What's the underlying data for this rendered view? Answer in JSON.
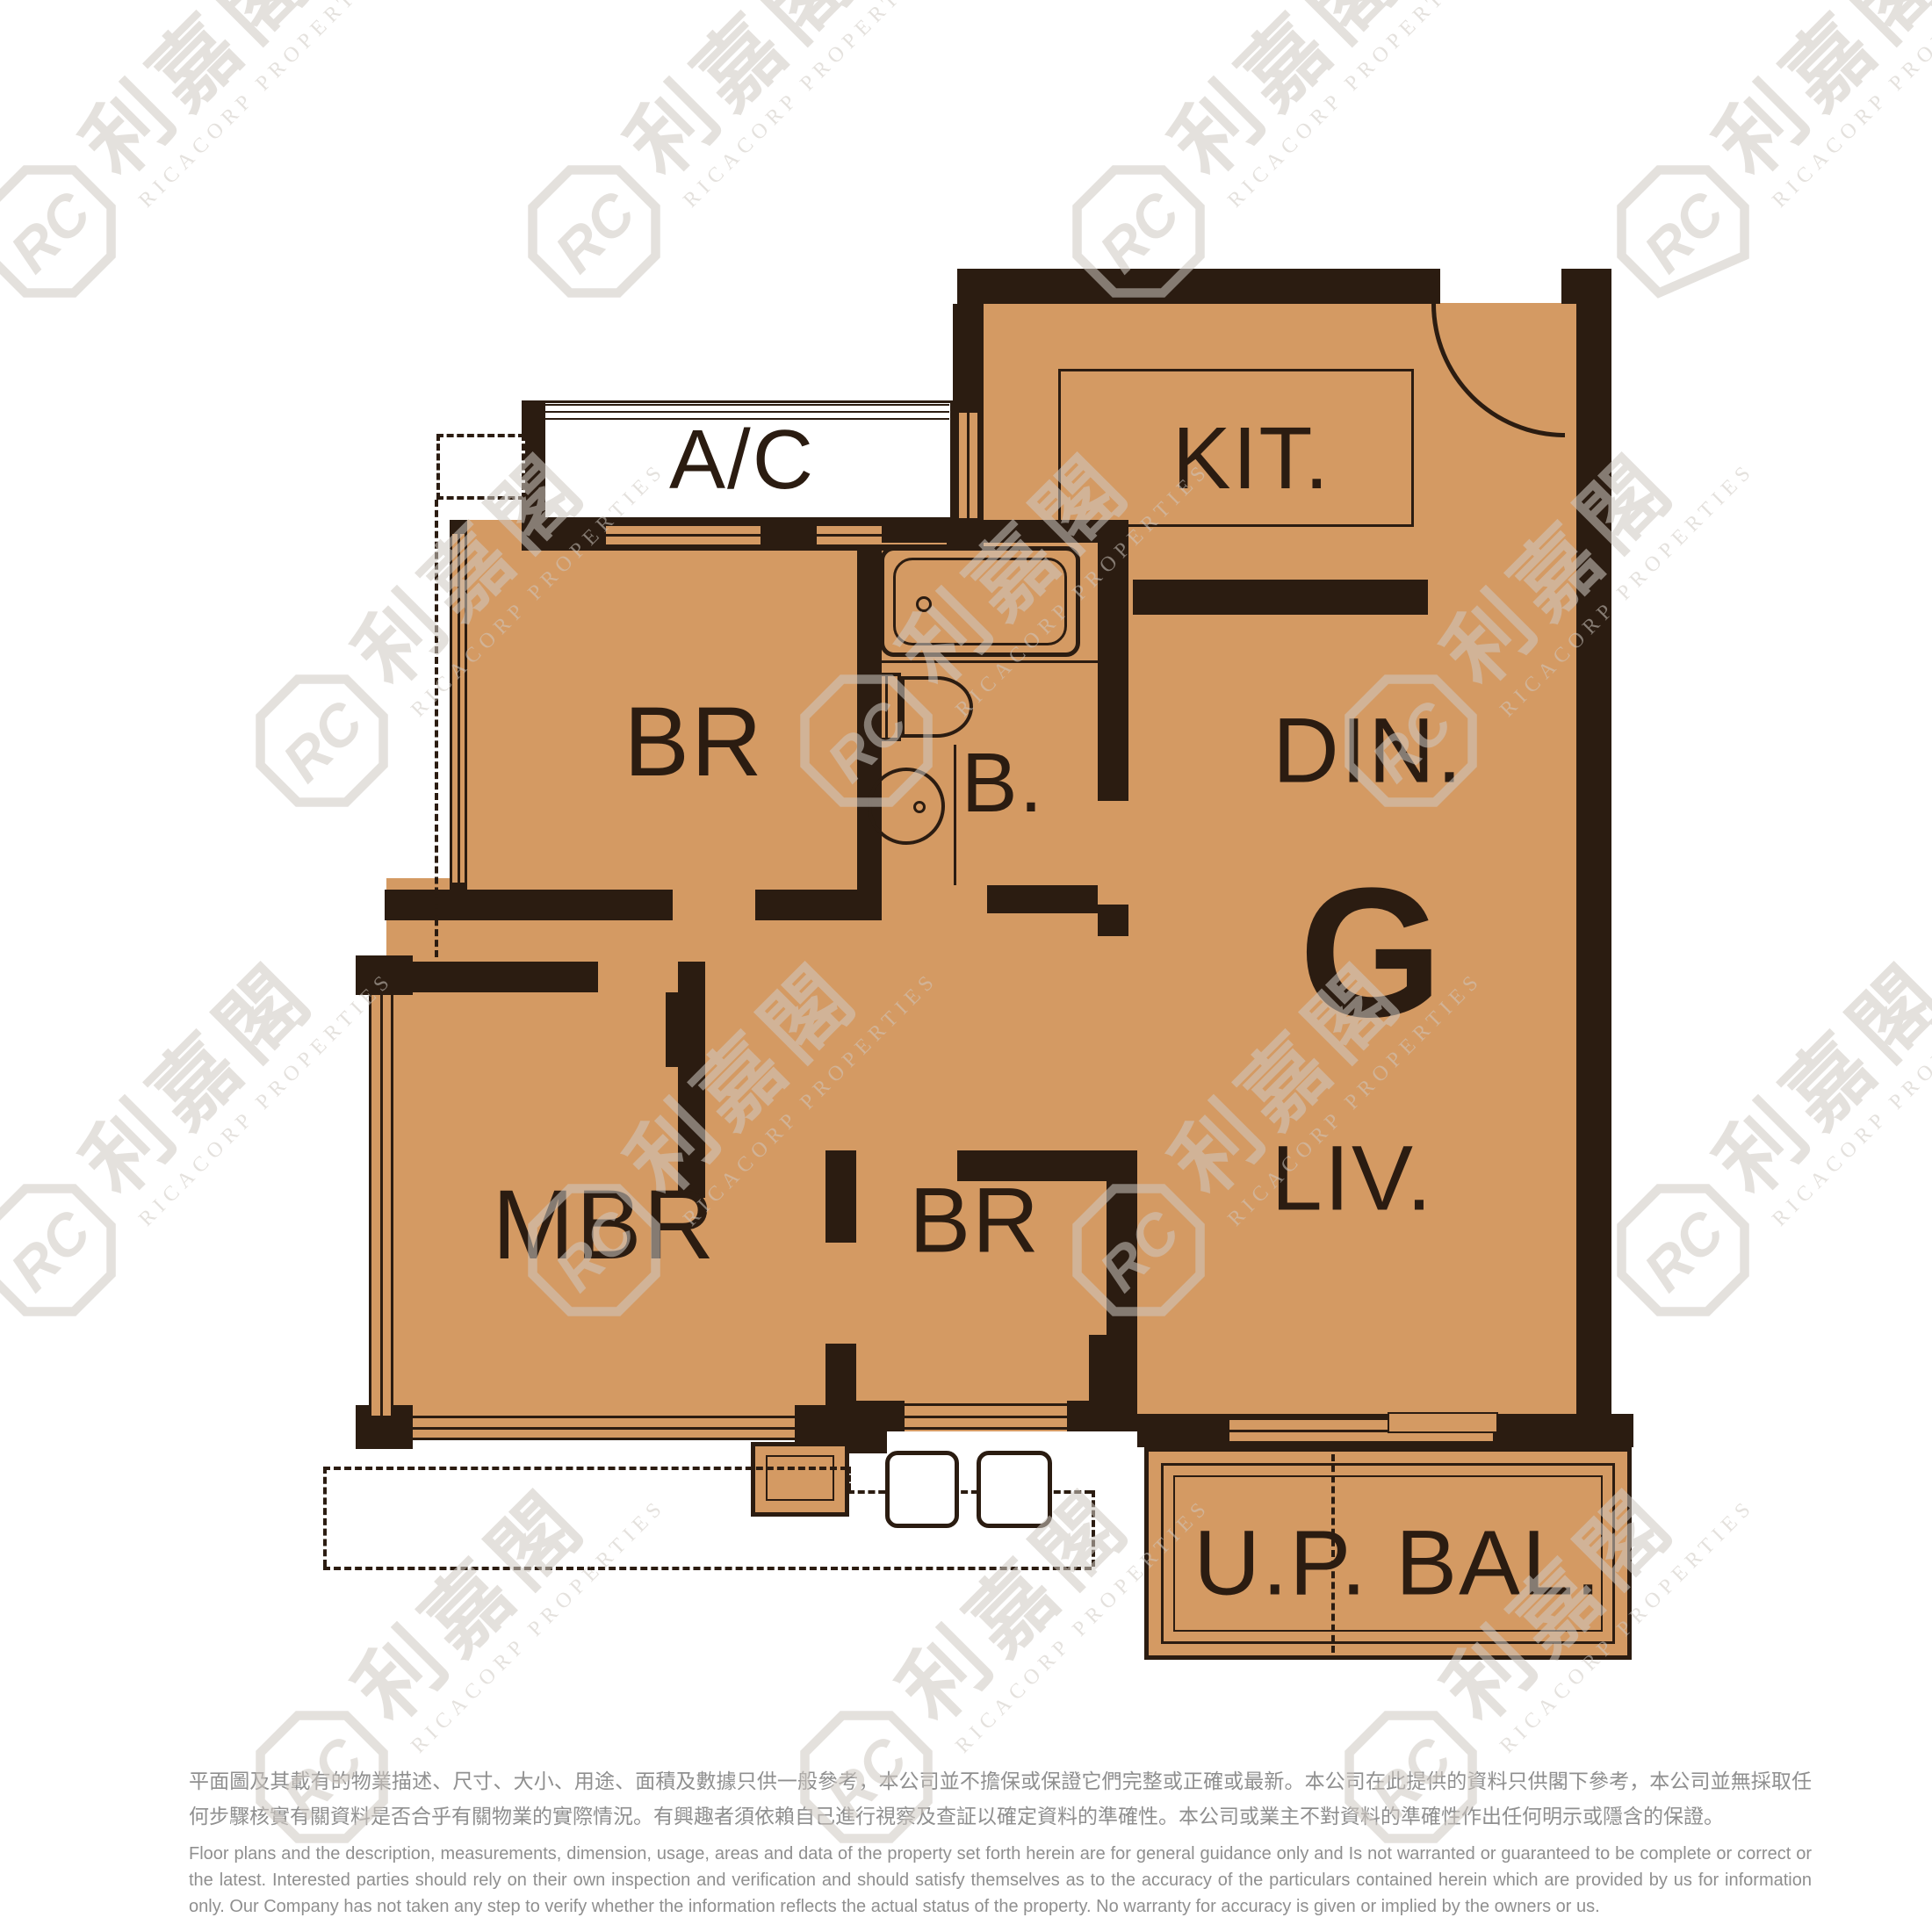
{
  "palette": {
    "floor_fill": "#D49A63",
    "wall": "#2B1C11",
    "watermark": "#CFC9C2",
    "disclaimer_text": "#8F8F8F",
    "background": "#FFFFFF"
  },
  "rooms": {
    "ac": {
      "label": "A/C"
    },
    "kit": {
      "label": "KIT."
    },
    "br1": {
      "label": "BR"
    },
    "bath": {
      "label": "B."
    },
    "din": {
      "label": "DIN."
    },
    "unit": {
      "label": "G"
    },
    "liv": {
      "label": "LIV."
    },
    "mbr": {
      "label": "MBR"
    },
    "br2": {
      "label": "BR"
    },
    "bal": {
      "label": "U.P. BAL."
    }
  },
  "watermark": {
    "monogram": "RC",
    "name_zh": "利嘉閣",
    "name_en": "RICACORP PROPERTIES"
  },
  "disclaimer": {
    "zh": "平面圖及其載有的物業描述、尺寸、大小、用途、面積及數據只供一般參考，本公司並不擔保或保證它們完整或正確或最新。本公司在此提供的資料只供閣下參考，本公司並無採取任何步驟核實有關資料是否合乎有關物業的實際情況。有興趣者須依賴自己進行視察及查証以確定資料的準確性。本公司或業主不對資料的準確性作出任何明示或隱含的保證。",
    "en": "Floor plans and the description, measurements, dimension, usage, areas and data of the property set forth herein are for general guidance only and Is not warranted or guaranteed to be complete or correct or the latest. Interested parties should rely on their own inspection and verification and should satisfy themselves as to the accuracy of the particulars contained herein which are provided by us for information only.  Our Company has not taken any step to verify whether the information reflects the actual status of the property.  No warranty for accuracy is given or implied by the owners or us."
  }
}
